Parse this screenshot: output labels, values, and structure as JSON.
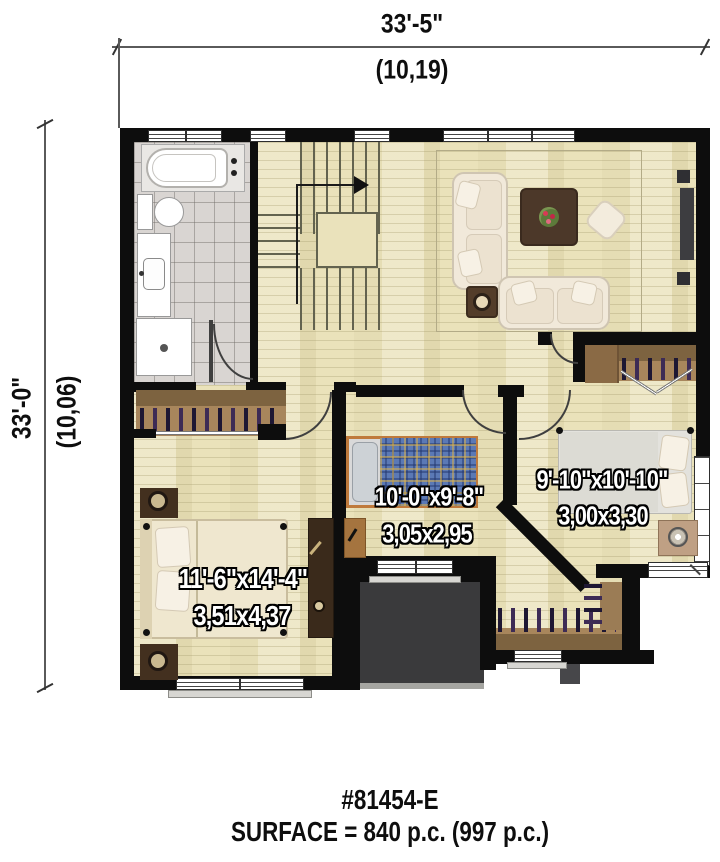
{
  "plan": {
    "dimensions": {
      "width_imperial": "33'-5\"",
      "width_metric": "(10,19)",
      "height_imperial": "33'-0\"",
      "height_metric": "(10,06)"
    },
    "rooms": {
      "master_bedroom": {
        "size_imperial": "11'-6\"x14'-4\"",
        "size_metric": "3,51x4,37"
      },
      "bedroom_2": {
        "size_imperial": "10'-0\"x9'-8\"",
        "size_metric": "3,05x2,95"
      },
      "bedroom_3": {
        "size_imperial": "9'-10\"x10'-10\"",
        "size_metric": "3,00x3,30"
      }
    },
    "footer": {
      "plan_number": "#81454-E",
      "surface": "SURFACE = 840 p.c. (997 p.c.)"
    },
    "colors": {
      "wall": "#0d0d0d",
      "wood_floor": "#eae2bb",
      "tile_floor": "#d9d5d2",
      "closet_wood": "#9b7c55",
      "roof_below": "#3a3a3c",
      "label_text": "#ffffff"
    }
  }
}
